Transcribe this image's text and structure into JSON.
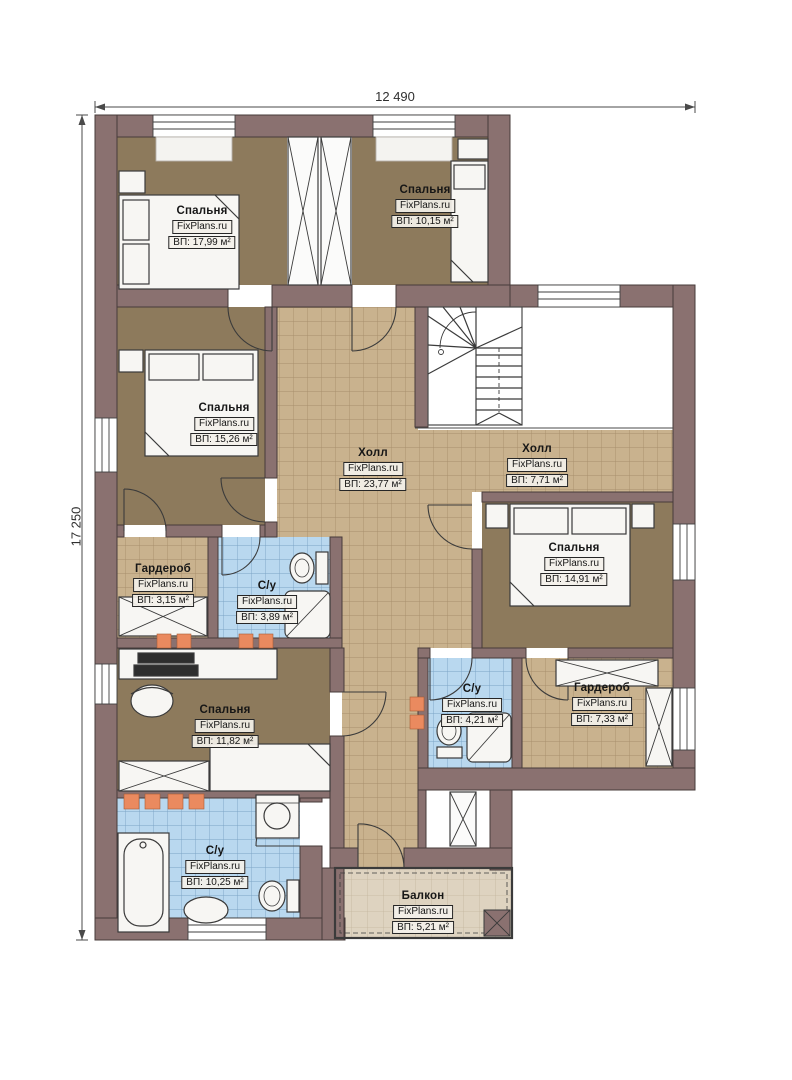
{
  "dimensions": {
    "width_label": "12 490",
    "height_label": "17 250"
  },
  "rooms": [
    {
      "name": "Спальня",
      "brand": "FixPlans.ru",
      "area": "ВП: 17,99 м²"
    },
    {
      "name": "Спальня",
      "brand": "FixPlans.ru",
      "area": "ВП: 10,15 м²"
    },
    {
      "name": "Спальня",
      "brand": "FixPlans.ru",
      "area": "ВП: 15,26 м²"
    },
    {
      "name": "Холл",
      "brand": "FixPlans.ru",
      "area": "ВП: 23,77 м²"
    },
    {
      "name": "Холл",
      "brand": "FixPlans.ru",
      "area": "ВП: 7,71 м²"
    },
    {
      "name": "Спальня",
      "brand": "FixPlans.ru",
      "area": "ВП: 14,91 м²"
    },
    {
      "name": "Гардероб",
      "brand": "FixPlans.ru",
      "area": "ВП: 3,15 м²"
    },
    {
      "name": "С/у",
      "brand": "FixPlans.ru",
      "area": "ВП: 3,89 м²"
    },
    {
      "name": "Спальня",
      "brand": "FixPlans.ru",
      "area": "ВП: 11,82 м²"
    },
    {
      "name": "С/у",
      "brand": "FixPlans.ru",
      "area": "ВП: 4,21 м²"
    },
    {
      "name": "Гардероб",
      "brand": "FixPlans.ru",
      "area": "ВП: 7,33 м²"
    },
    {
      "name": "С/у",
      "brand": "FixPlans.ru",
      "area": "ВП: 10,25 м²"
    },
    {
      "name": "Балкон",
      "brand": "FixPlans.ru",
      "area": "ВП: 5,21 м²"
    }
  ],
  "colors": {
    "wall": "#8a7170",
    "bedroom_floor": "#8d7a5c",
    "tile_floor": "#c9b28e",
    "bath_floor": "#b9d8ef",
    "balcony_floor": "#ded3c0",
    "marker": "#ea8a5f"
  }
}
